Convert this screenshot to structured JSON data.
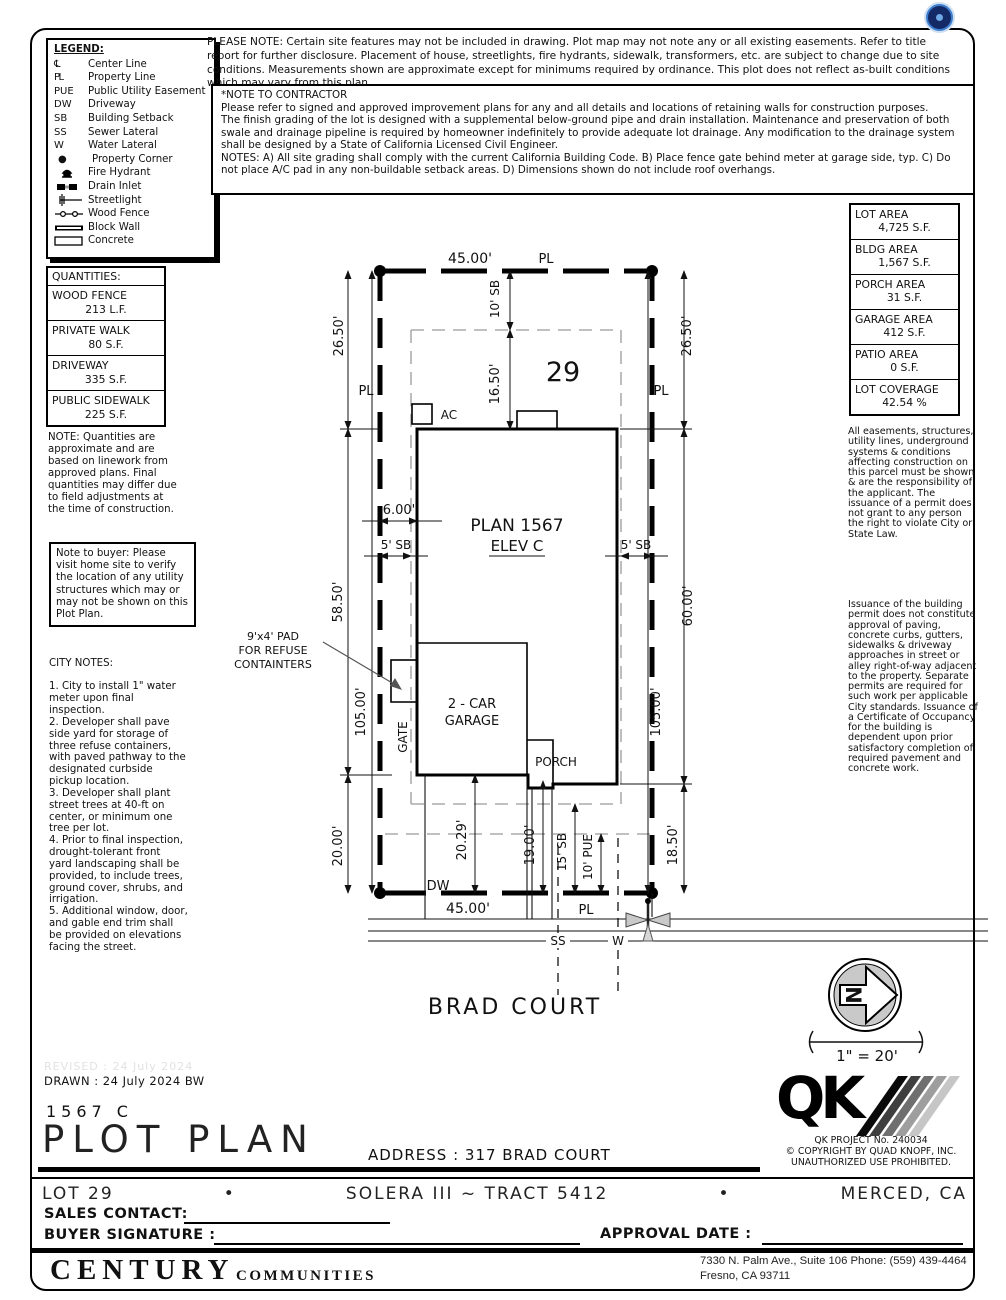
{
  "legend": {
    "title": "LEGEND:",
    "items": [
      {
        "symbol": "℄",
        "label": "Center Line"
      },
      {
        "symbol": "PL",
        "label": "Property Line"
      },
      {
        "symbol": "PUE",
        "label": "Public Utility Easement"
      },
      {
        "symbol": "DW",
        "label": "Driveway"
      },
      {
        "symbol": "SB",
        "label": "Building Setback"
      },
      {
        "symbol": "SS",
        "label": "Sewer Lateral"
      },
      {
        "symbol": "W",
        "label": "Water Lateral"
      },
      {
        "symbol": "●",
        "label": "Property Corner"
      },
      {
        "symbol": "",
        "label": "Fire Hydrant"
      },
      {
        "symbol": "",
        "label": "Drain Inlet"
      },
      {
        "symbol": "",
        "label": "Streetlight"
      },
      {
        "symbol": "",
        "label": "Wood Fence"
      },
      {
        "symbol": "",
        "label": "Block Wall"
      },
      {
        "symbol": "",
        "label": "Concrete"
      }
    ]
  },
  "please_note": "PLEASE NOTE:  Certain site features may not be included in drawing.  Plot map may not note any or all existing easements. Refer to title report for further disclosure.  Placement of house, streetlights, fire hydrants, sidewalk, transformers, etc. are subject to change due to site conditions.  Measurements shown are approximate except for minimums required by ordinance.  This plot does not reflect as-built conditions which may vary from this plan.",
  "contractor_note": {
    "line1": "*NOTE TO CONTRACTOR",
    "line2": "Please refer to signed and approved improvement plans for any and all details and locations of retaining walls for construction purposes.",
    "line3": "The finish grading of the lot is designed with a supplemental below-ground pipe and drain installation.  Maintenance and preservation of both swale and drainage pipeline is required by homeowner indefinitely to provide adequate lot drainage.  Any modification to the drainage system shall be designed by a State of California Licensed Civil Engineer.",
    "line4": "NOTES:  A) All site grading shall comply with the current California Building Code.  B) Place fence gate behind meter at garage side, typ.  C) Do not place A/C pad in any non-buildable setback areas.  D) Dimensions shown do not include roof overhangs."
  },
  "area_table": {
    "rows": [
      {
        "label": "LOT AREA",
        "value": "4,725 S.F."
      },
      {
        "label": "BLDG AREA",
        "value": "1,567 S.F."
      },
      {
        "label": "PORCH AREA",
        "value": "31 S.F."
      },
      {
        "label": "GARAGE AREA",
        "value": "412 S.F."
      },
      {
        "label": "PATIO AREA",
        "value": "0 S.F."
      },
      {
        "label": "LOT COVERAGE",
        "value": "42.54 %"
      }
    ]
  },
  "quantities": {
    "title": "QUANTITIES:",
    "rows": [
      {
        "label": "WOOD FENCE",
        "value": "213 L.F."
      },
      {
        "label": "PRIVATE WALK",
        "value": "80 S.F."
      },
      {
        "label": "DRIVEWAY",
        "value": "335 S.F."
      },
      {
        "label": "PUBLIC SIDEWALK",
        "value": "225 S.F."
      }
    ],
    "note": "NOTE: Quantities are approximate and are based on linework from approved plans.  Final quantities may differ due to field adjustments at the time of construction."
  },
  "buyer_note": "Note to buyer: Please visit home site to verify the location of any utility structures which may or may not be shown on this Plot Plan.",
  "city_notes": {
    "title": "CITY NOTES:",
    "body": "1. City to install 1\" water\nmeter upon final inspection.\n2. Developer shall pave\nside yard for storage of\nthree refuse containers,\nwith paved pathway to the\ndesignated curbside\npickup location.\n3. Developer shall plant\nstreet trees at 40-ft on\ncenter, or minimum one\ntree per lot.\n4. Prior to final inspection,\ndrought-tolerant front\nyard landscaping shall be\nprovided, to include trees,\nground cover, shrubs, and\nirrigation.\n5. Additional window, door,\nand gable end trim shall\nbe provided on elevations\nfacing the street."
  },
  "right_notes": {
    "para1": "All easements, structures, utility lines, underground systems & conditions affecting construction on this parcel must be shown & are the responsibility of the applicant. The issuance of a permit does not grant to any person the right to violate City or State Law.",
    "para2": "Issuance of the building permit does not constitute approval of paving, concrete curbs, gutters, sidewalks & driveway approaches in street or alley right-of-way adjacent to the property. Separate permits are required for such work per applicable City standards. Issuance of a Certificate of Occupancy for the building is dependent upon prior satisfactory completion of required pavement and concrete work."
  },
  "plot": {
    "lot_number": "29",
    "pl": "PL",
    "top_width": "45.00'",
    "bottom_width": "45.00'",
    "rear_offset_left": "26.50'",
    "rear_offset_right": "26.50'",
    "rear_sb": "10' SB",
    "rear_to_house": "16.50'",
    "ac": "AC",
    "side_gap": "6.00'",
    "plan_name": "PLAN 1567",
    "elev": "ELEV C",
    "side_sb_left": "5' SB",
    "side_sb_right": "5' SB",
    "house_depth_left": "58.50'",
    "house_depth_right": "60.00'",
    "lot_depth_left": "105.00'",
    "lot_depth_right": "105.00'",
    "refuse_note": "9'x4' PAD\nFOR REFUSE\nCONTAINTERS",
    "gate": "GATE",
    "garage_line1": "2 - CAR",
    "garage_line2": "GARAGE",
    "porch": "PORCH",
    "front_left": "20.00'",
    "driveway_len": "20.29'",
    "porch_to_pl": "19.00'",
    "front_sb": "15' SB",
    "pue": "10' PUE",
    "front_right": "18.50'",
    "dw": "DW",
    "ss": "SS",
    "w": "W",
    "street_name": "BRAD COURT",
    "north_letter": "N",
    "scale": "1\" = 20'"
  },
  "title_block": {
    "revised": "REVISED :  24 July 2024",
    "drawn": "DRAWN :  24 July 2024  BW",
    "plan_code": "1567  C",
    "sheet_title": "PLOT PLAN",
    "address": "ADDRESS :  317 BRAD COURT",
    "qk_logo": "QK",
    "qk_project": "QK PROJECT No. 240034",
    "copyright1": "©  COPYRIGHT BY QUAD KNOPF, INC.",
    "copyright2": "UNAUTHORIZED USE PROHIBITED.",
    "lot": "LOT 29",
    "bullet": "•",
    "tract": "SOLERA III ~ TRACT 5412",
    "city": "MERCED, CA",
    "sales_contact": "SALES CONTACT:",
    "buyer_signature": "BUYER SIGNATURE :",
    "approval_date": "APPROVAL DATE :",
    "brand": "CENTURY",
    "brand2": "COMMUNITIES",
    "office_addr1": "7330 N. Palm Ave., Suite 106    Phone:  (559) 439-4464",
    "office_addr2": "Fresno, CA  93711"
  }
}
